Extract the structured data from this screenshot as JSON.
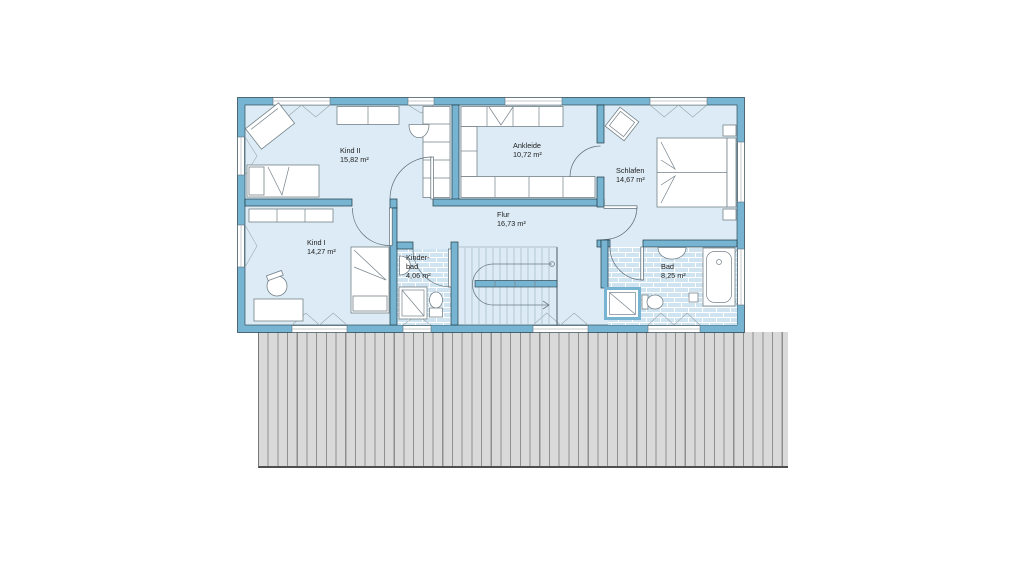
{
  "colors": {
    "wall": "#77b4d1",
    "wall_outline": "#1d3945",
    "floor": "#dcebf5",
    "tile": "#cfe4f0",
    "furniture_line": "#75828a",
    "hatch_fill": "#d9d9d9",
    "hatch_line": "#8f8f8f",
    "text": "#222222"
  },
  "rooms": [
    {
      "id": "kind-ii",
      "name": "Kind II",
      "area": "15,82 m²"
    },
    {
      "id": "ankleide",
      "name": "Ankleide",
      "area": "10,72 m²"
    },
    {
      "id": "schlafen",
      "name": "Schlafen",
      "area": "14,67 m²"
    },
    {
      "id": "kind-i",
      "name": "Kind I",
      "area": "14,27 m²"
    },
    {
      "id": "flur",
      "name": "Flur",
      "area": "16,73 m²"
    },
    {
      "id": "kinderbad",
      "name": "Kinder-\nbad",
      "area": "4,06 m²"
    },
    {
      "id": "bad",
      "name": "Bad",
      "area": "8,25 m²"
    }
  ]
}
